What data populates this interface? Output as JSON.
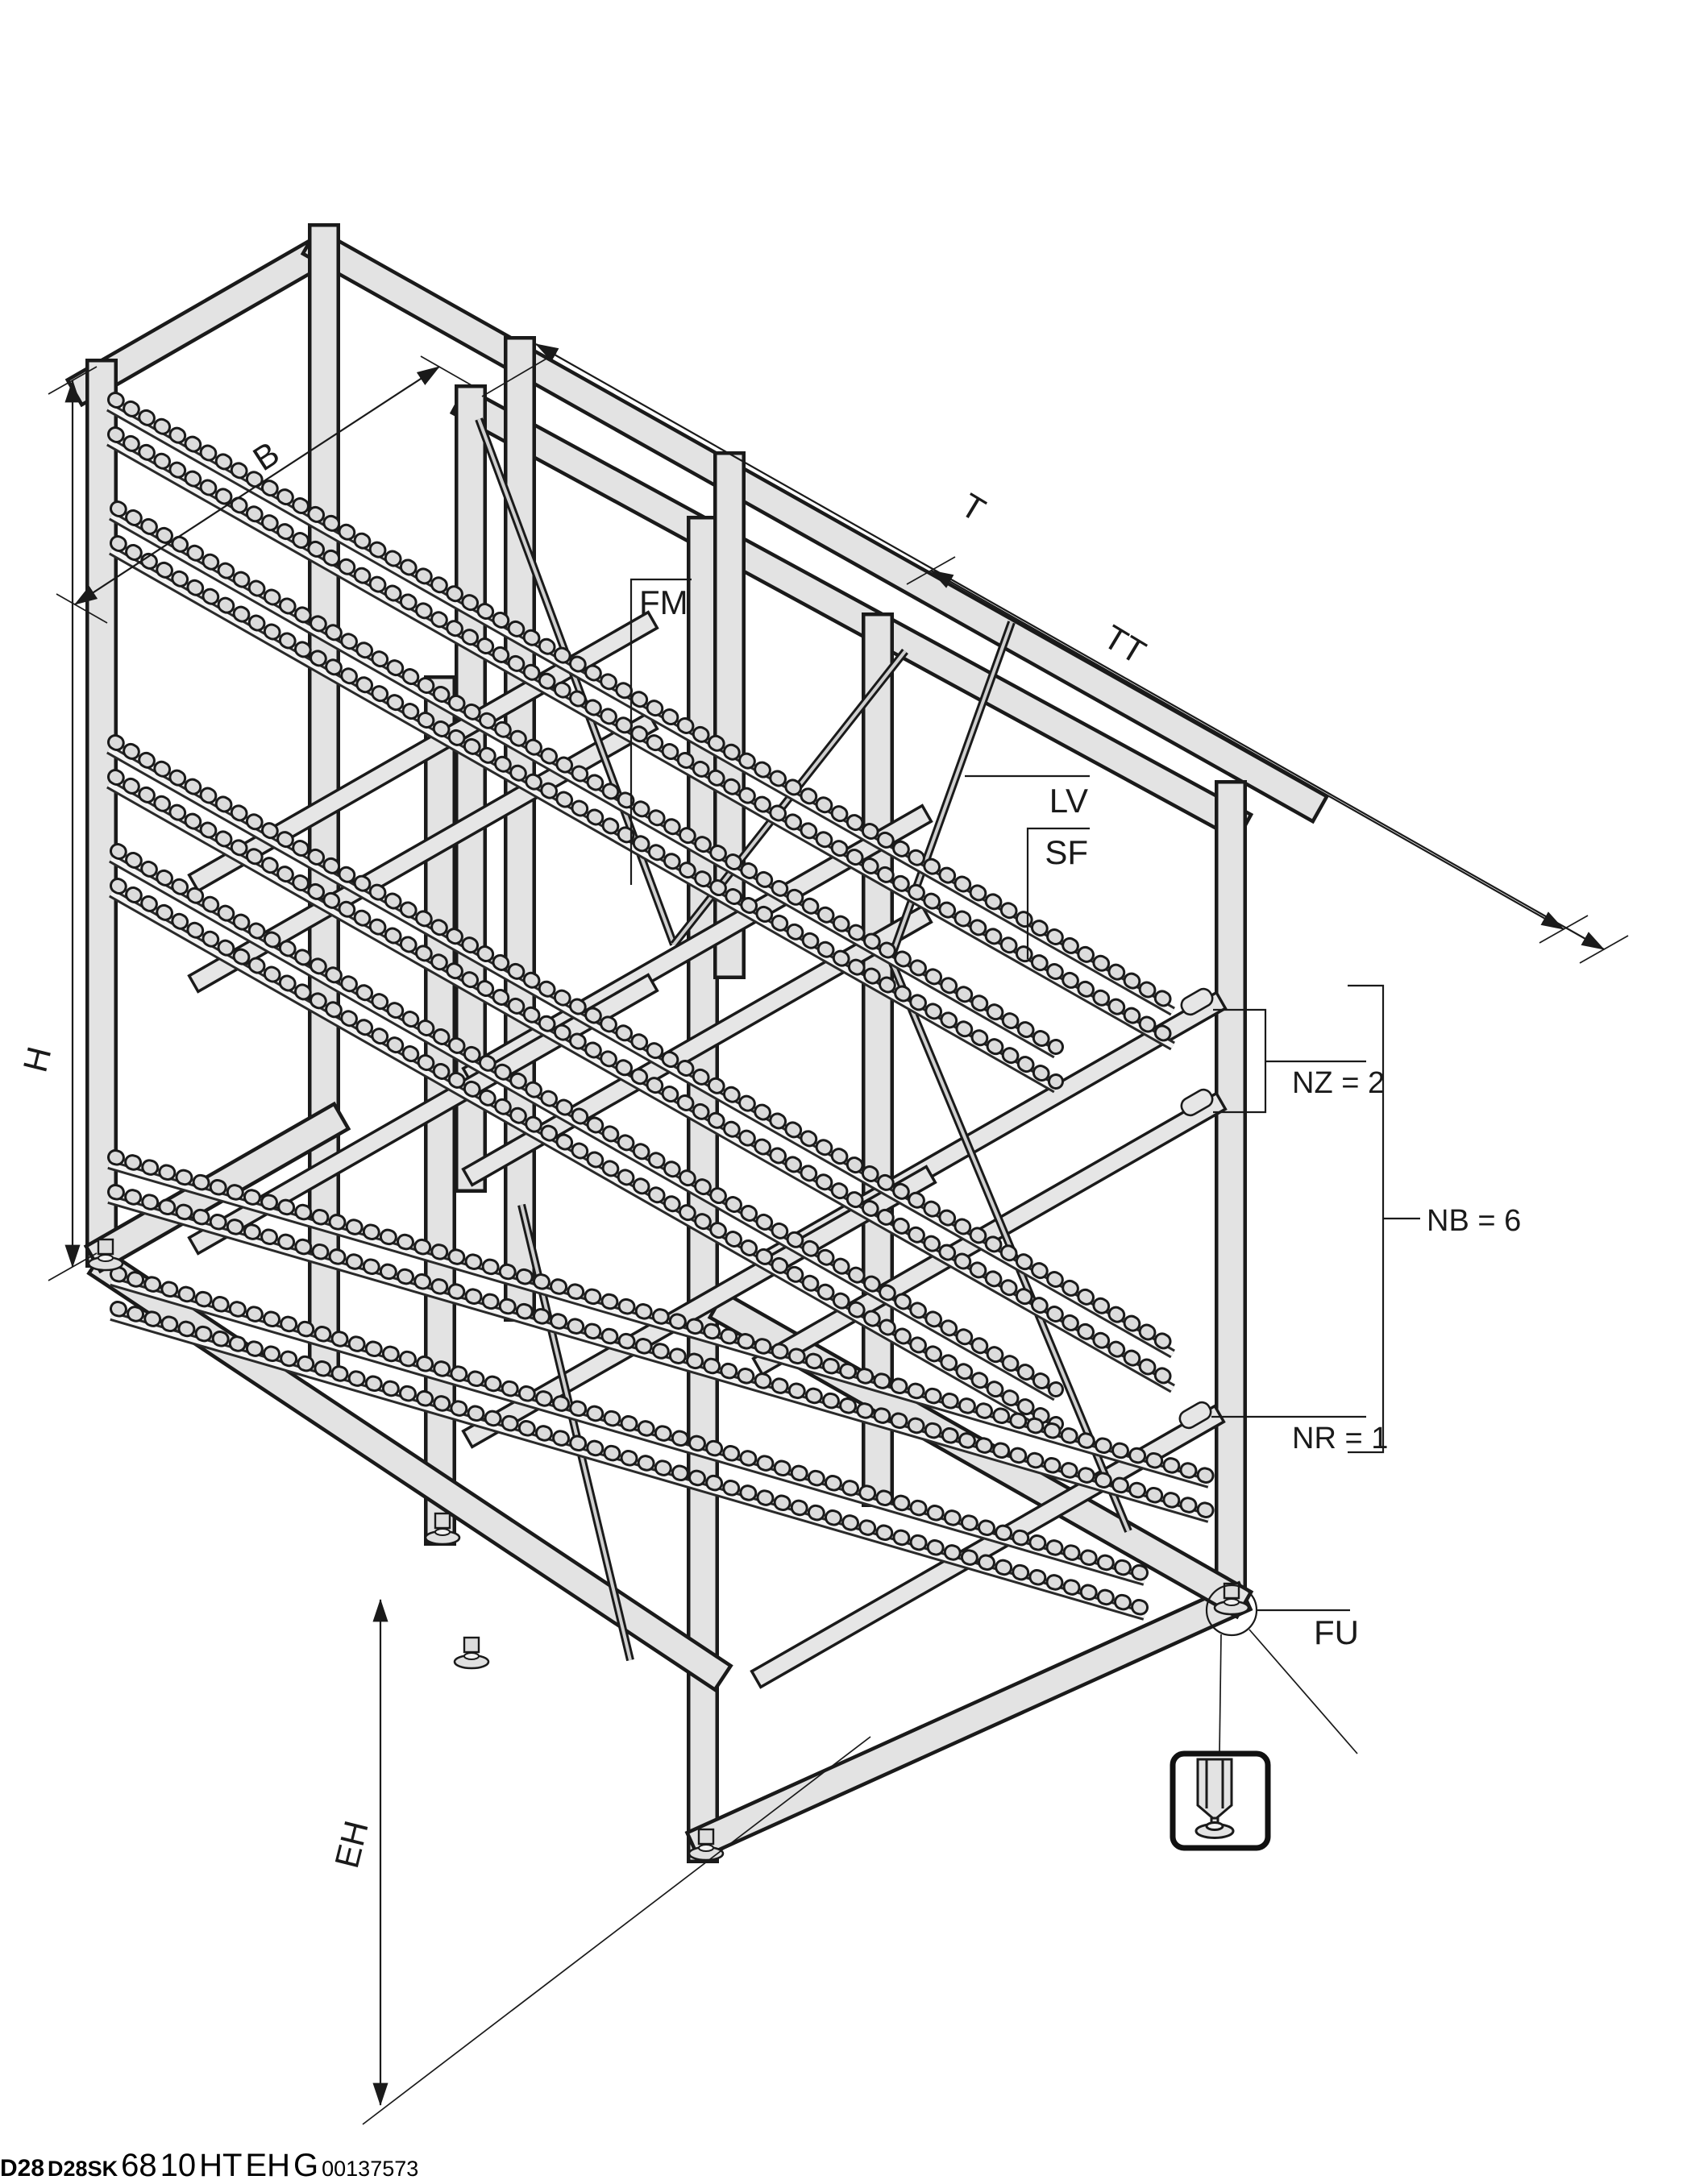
{
  "page": {
    "image_id": "00137573"
  },
  "product_icons": {
    "icon1_label": "D28",
    "icon2_label": "D28SK"
  },
  "main_view": {
    "dim_width": "B",
    "dim_depth": "T",
    "dim_total_depth": "TT",
    "dim_height": "H",
    "dim_infeed_height": "EH",
    "callout_roller_track": "FM",
    "callout_brace": "LV",
    "callout_frame_profile": "SF",
    "callout_foot": "FU",
    "count_supply_levels": "NZ = 2",
    "count_tracks": "NB = 6",
    "count_return_levels": "NR = 1"
  },
  "detail_view": {
    "dim_bracket_offset": "68",
    "dim_gap": "10",
    "dim_level_pitch": "HT",
    "dim_infeed_height": "EH",
    "dim_incline_angle": "G"
  },
  "colors": {
    "line": "#1a1a1a",
    "beam_fill": "#e3e3e3",
    "background": "#ffffff"
  }
}
